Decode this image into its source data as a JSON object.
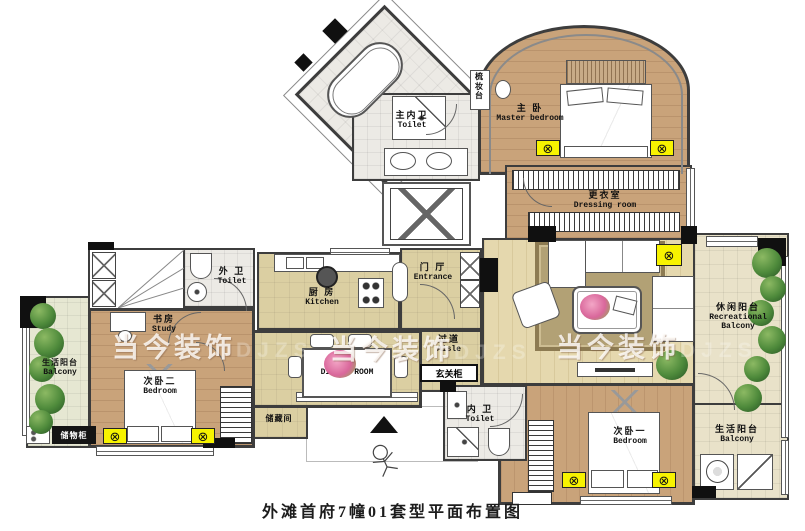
{
  "meta": {
    "caption": "外滩首府7幢01套型平面布置图",
    "watermark": "当今装饰",
    "watermark_suffix": "DJZS"
  },
  "rooms": {
    "master_bedroom": {
      "zh": "主 卧",
      "en": "Master bedroom"
    },
    "master_toilet": {
      "zh": "主内卫",
      "en": "Toilet"
    },
    "dressing_table": {
      "zh": "梳妆台"
    },
    "dressing_room": {
      "zh": "更衣室",
      "en": "Dressing room"
    },
    "outer_toilet": {
      "zh": "外 卫",
      "en": "Toilet"
    },
    "kitchen": {
      "zh": "厨 房",
      "en": "Kitchen"
    },
    "entrance": {
      "zh": "门 厅",
      "en": "Entrance"
    },
    "aisle": {
      "zh": "过道",
      "en": "Aisle"
    },
    "entry_cabinet": {
      "zh": "玄关柜"
    },
    "dining_room": {
      "en": "DINING ROOM"
    },
    "study": {
      "zh": "书房",
      "en": "Study"
    },
    "bedroom_two": {
      "zh": "次卧二",
      "en": "Bedroom"
    },
    "life_balcony_left": {
      "zh": "生活阳台",
      "en": "Balcony"
    },
    "storage_cabinet": {
      "zh": "储物柜"
    },
    "storage_room": {
      "zh": "储藏间"
    },
    "recreational_balcony": {
      "zh": "休闲阳台",
      "en": "Recreational Balcony"
    },
    "life_balcony_right": {
      "zh": "生活阳台",
      "en": "Balcony"
    },
    "inner_toilet": {
      "zh": "内 卫",
      "en": "Toilet"
    },
    "bedroom_one": {
      "zh": "次卧一",
      "en": "Bedroom"
    }
  },
  "colors": {
    "wall": "#3d3d3d",
    "wood_floor": "#c9a37a",
    "tile_floor": "#dbcfa2",
    "lamp_symbol": "#f7f300"
  }
}
